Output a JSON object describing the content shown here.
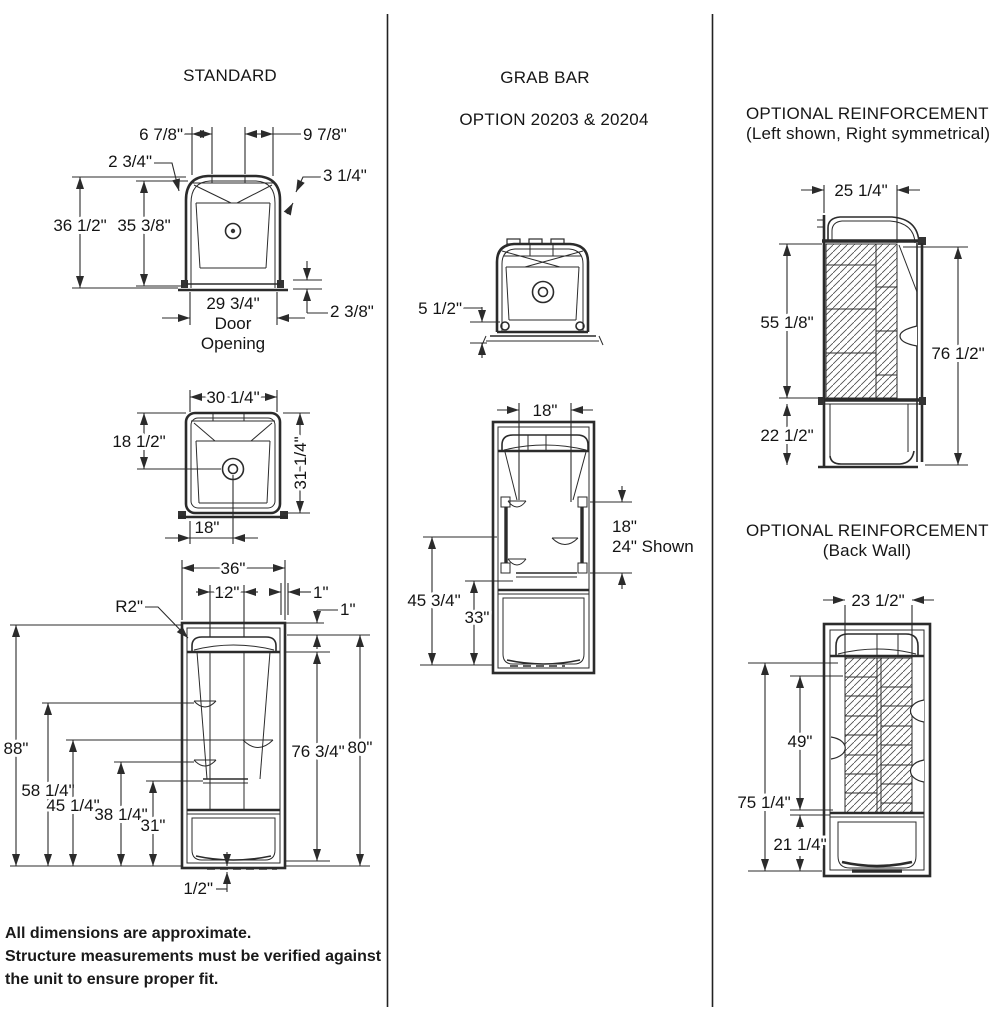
{
  "columns": {
    "standard": {
      "title": "STANDARD",
      "front_view": {
        "left_top_offset": "6 7/8\"",
        "right_top_offset": "9 7/8\"",
        "left_corner": "2 3/4\"",
        "right_corner": "3 1/4\"",
        "overall_height": "36 1/2\"",
        "interior_height": "35 3/8\"",
        "door_opening_width": "29 3/4\"",
        "door_opening_line1": "Door",
        "door_opening_line2": "Opening",
        "base_height": "2 3/8\""
      },
      "plan_view": {
        "top_width": "30 1/4\"",
        "drain_depth": "18 1/2\"",
        "overall_depth": "31 1/4\"",
        "drain_offset": "18\""
      },
      "elevation": {
        "overall_width": "36\"",
        "center_panel_width": "12\"",
        "edge_offset": "1\"",
        "top_lip": "1\"",
        "corner_radius": "R2\"",
        "overall_height": "88\"",
        "upper_shelf_height": "58 1/4\"",
        "right_shelf_height": "45 1/4\"",
        "lower_shelf_height": "38 1/4\"",
        "towel_bar_height": "31\"",
        "interior_height": "76 3/4\"",
        "unit_height": "80\"",
        "threshold": "1/2\""
      }
    },
    "grab_bar": {
      "title": "GRAB BAR",
      "subtitle": "OPTION 20203 & 20204",
      "plan_view": {
        "mount_height": "5 1/2\""
      },
      "elevation": {
        "bar_spacing": "18\"",
        "bar_length": "18\"",
        "bar_length_shown": "24\" Shown",
        "upper_mount_height": "45 3/4\"",
        "lower_mount_height": "33\""
      }
    },
    "reinforcement_side": {
      "title": "OPTIONAL REINFORCEMENT",
      "subtitle": "(Left shown, Right symmetrical)",
      "depth": "25 1/4\"",
      "panel_height": "55 1/8\"",
      "overall_height": "76 1/2\"",
      "lower_height": "22 1/2\""
    },
    "reinforcement_back": {
      "title": "OPTIONAL REINFORCEMENT",
      "subtitle": "(Back Wall)",
      "panel_width": "23 1/2\"",
      "panel_height": "49\"",
      "overall_height": "75 1/4\"",
      "lower_height": "21 1/4\""
    }
  },
  "footer": {
    "line1": "All dimensions are approximate.",
    "line2": "Structure measurements must be verified against",
    "line3": "the unit to ensure proper fit."
  },
  "colors": {
    "ink": "#1a1a1a",
    "background": "#ffffff"
  }
}
